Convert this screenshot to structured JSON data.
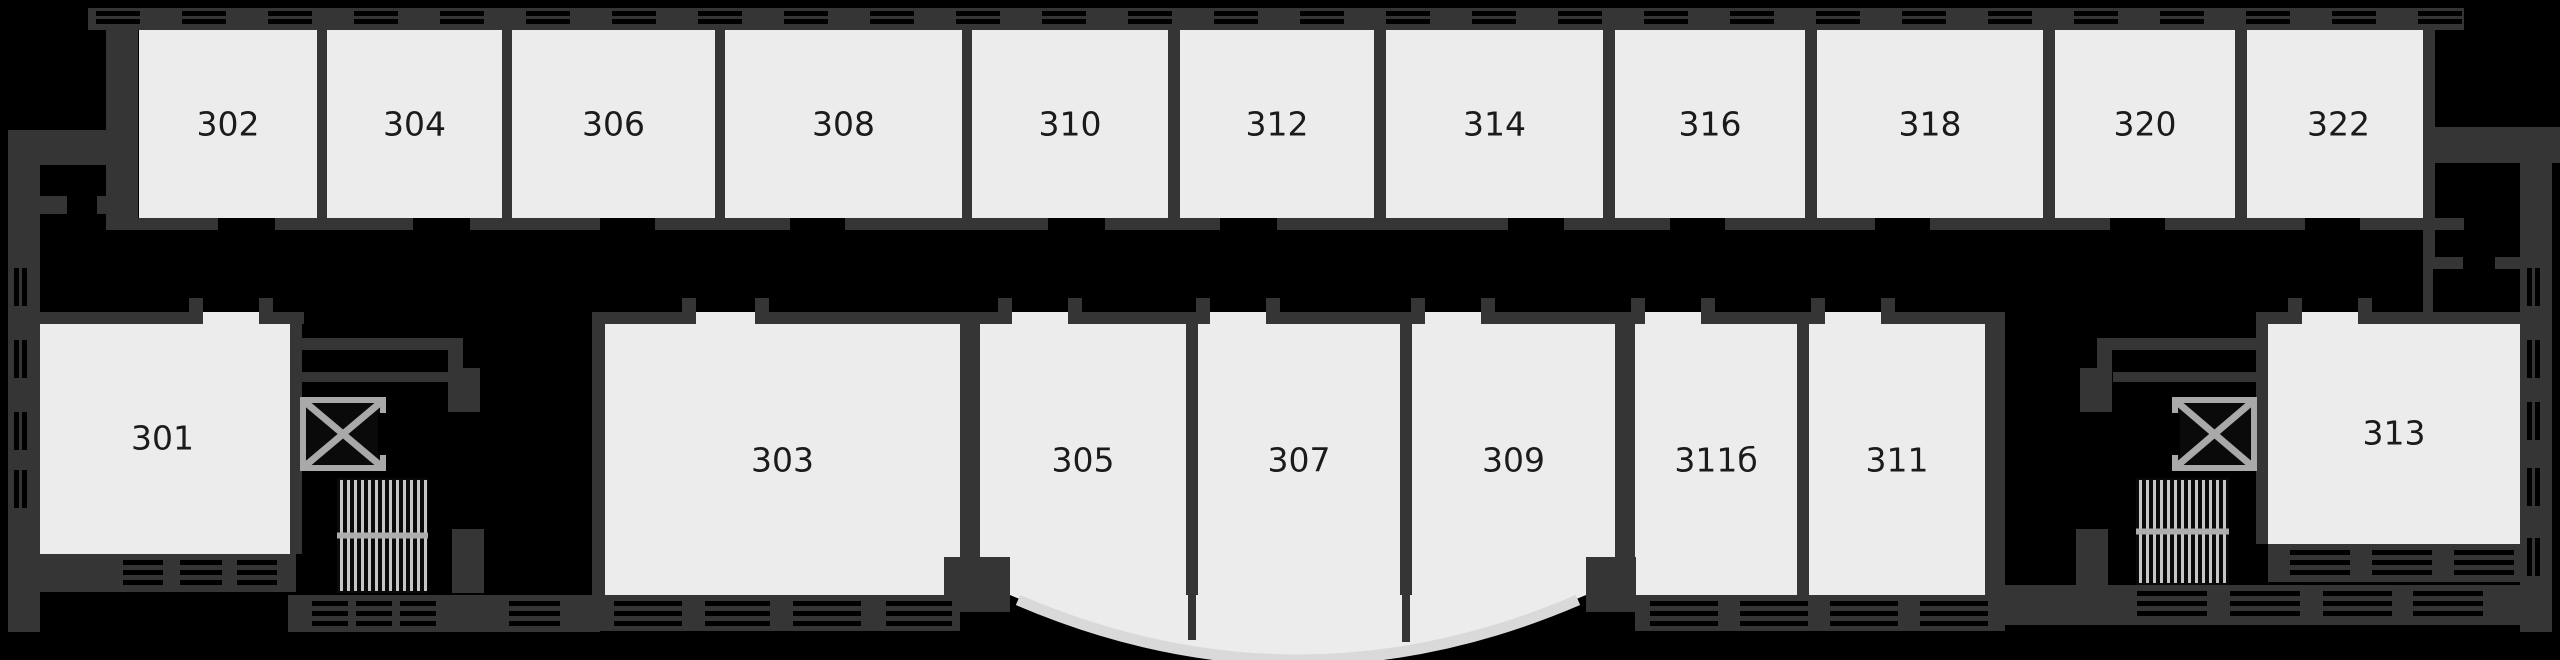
{
  "palette": {
    "background": "#000000",
    "wall": "#353535",
    "room_fill": "#ececec",
    "label_color": "#1b1b1b",
    "window_bar": "#000000",
    "fixture_gray": "#a9a9a9",
    "fixture_fill": "#0a0a0a",
    "stair_stripe": "#c6c6c6",
    "stair_rail": "#adadad",
    "bay_arc": "#d9d9d9"
  },
  "canvas": {
    "width": 2560,
    "height": 660
  },
  "diagram_data": {
    "type": "floor_plan",
    "top_row_rooms": [
      "302",
      "304",
      "306",
      "308",
      "310",
      "312",
      "314",
      "316",
      "318",
      "320",
      "322"
    ],
    "bottom_row_rooms": [
      "301",
      "303",
      "305",
      "307",
      "309",
      "311б",
      "311",
      "313"
    ],
    "fixtures": [
      "elevator-left",
      "stairs-left",
      "elevator-right",
      "stairs-right"
    ],
    "features": [
      "curved bay window under rooms 305-309",
      "window hatching along exterior walls",
      "central corridor between room rows"
    ]
  },
  "floorplan": {
    "rooms": {
      "top_row": {
        "y": 30,
        "h": 188,
        "label_cy": 124,
        "items": [
          {
            "label": "302",
            "x": 139,
            "w": 178,
            "door": [
              218,
              275
            ]
          },
          {
            "label": "304",
            "x": 327,
            "w": 175,
            "door": [
              413,
              470
            ]
          },
          {
            "label": "306",
            "x": 512,
            "w": 203,
            "door": [
              600,
              655
            ]
          },
          {
            "label": "308",
            "x": 725,
            "w": 237,
            "door": [
              790,
              845
            ]
          },
          {
            "label": "310",
            "x": 972,
            "w": 196,
            "door": [
              1048,
              1105
            ]
          },
          {
            "label": "312",
            "x": 1180,
            "w": 194,
            "door": [
              1220,
              1277
            ]
          },
          {
            "label": "314",
            "x": 1386,
            "w": 217,
            "door": [
              1508,
              1564
            ]
          },
          {
            "label": "316",
            "x": 1615,
            "w": 190,
            "door": [
              1670,
              1725
            ]
          },
          {
            "label": "318",
            "x": 1817,
            "w": 226,
            "door": [
              1875,
              1930
            ]
          },
          {
            "label": "320",
            "x": 2055,
            "w": 180,
            "door": [
              2110,
              2165
            ]
          },
          {
            "label": "322",
            "x": 2247,
            "w": 183,
            "door": [
              2305,
              2360
            ]
          }
        ]
      },
      "bottom_row": {
        "items": [
          {
            "label": "301",
            "x": 33,
            "y": 322,
            "w": 259,
            "h": 232,
            "door": [
              203,
              259
            ],
            "label_cy": 438
          },
          {
            "label": "303",
            "x": 605,
            "y": 324,
            "w": 355,
            "h": 271,
            "door": [
              696,
              755
            ],
            "label_cy": 460
          },
          {
            "label": "305",
            "x": 980,
            "y": 324,
            "w": 206,
            "h": 271,
            "door": [
              1012,
              1068
            ],
            "label_cy": 460
          },
          {
            "label": "307",
            "x": 1198,
            "y": 324,
            "w": 202,
            "h": 271,
            "door": [
              1210,
              1266
            ],
            "label_cy": 460
          },
          {
            "label": "309",
            "x": 1412,
            "y": 324,
            "w": 203,
            "h": 271,
            "door": [
              1425,
              1481
            ],
            "label_cy": 460
          },
          {
            "label": "311б",
            "x": 1635,
            "y": 324,
            "w": 162,
            "h": 271,
            "door": [
              1645,
              1701
            ],
            "label_cy": 460
          },
          {
            "label": "311",
            "x": 1809,
            "y": 324,
            "w": 176,
            "h": 271,
            "door": [
              1825,
              1881
            ],
            "label_cy": 460
          },
          {
            "label": "313",
            "x": 2268,
            "y": 322,
            "w": 252,
            "h": 222,
            "door": [
              2302,
              2358
            ],
            "label_cy": 433
          }
        ]
      }
    },
    "walls": [
      [
        88,
        8,
        2376,
        22,
        "top-window-band"
      ],
      [
        106,
        8,
        32,
        222,
        "left-end-wall"
      ],
      [
        8,
        130,
        130,
        35,
        "left-entry-band"
      ],
      [
        8,
        163,
        32,
        469,
        "left-exterior-wall"
      ],
      [
        32,
        196,
        35,
        18
      ],
      [
        97,
        196,
        33,
        18
      ],
      [
        2423,
        127,
        137,
        36,
        "right-entry-band"
      ],
      [
        2423,
        30,
        12,
        238,
        "right-end-wall"
      ],
      [
        2423,
        257,
        40,
        12
      ],
      [
        2495,
        257,
        32,
        12
      ],
      [
        2423,
        268,
        10,
        48
      ],
      [
        2520,
        163,
        32,
        469,
        "right-exterior-wall"
      ],
      [
        106,
        218,
        2358,
        12,
        "top-corridor-wall"
      ],
      [
        317,
        30,
        10,
        188
      ],
      [
        502,
        30,
        10,
        188
      ],
      [
        715,
        30,
        10,
        188
      ],
      [
        962,
        30,
        10,
        188
      ],
      [
        1168,
        30,
        12,
        188
      ],
      [
        1374,
        30,
        12,
        188
      ],
      [
        1603,
        30,
        12,
        188
      ],
      [
        1805,
        30,
        12,
        188
      ],
      [
        2043,
        30,
        12,
        188
      ],
      [
        2235,
        30,
        12,
        188
      ],
      [
        20,
        312,
        284,
        12
      ],
      [
        290,
        312,
        12,
        242
      ],
      [
        300,
        338,
        153,
        12
      ],
      [
        300,
        372,
        148,
        10
      ],
      [
        448,
        338,
        15,
        44
      ],
      [
        448,
        368,
        32,
        44
      ],
      [
        452,
        529,
        32,
        64
      ],
      [
        592,
        312,
        13,
        283
      ],
      [
        592,
        312,
        1413,
        12,
        "bottom-corridor-wall"
      ],
      [
        960,
        324,
        20,
        271
      ],
      [
        1186,
        324,
        12,
        271
      ],
      [
        1400,
        324,
        12,
        271
      ],
      [
        1615,
        324,
        20,
        271
      ],
      [
        1797,
        324,
        12,
        271
      ],
      [
        1985,
        324,
        20,
        271
      ],
      [
        1188,
        595,
        8,
        45
      ],
      [
        1402,
        595,
        8,
        47
      ],
      [
        944,
        557,
        66,
        55
      ],
      [
        1586,
        557,
        50,
        55
      ],
      [
        2256,
        312,
        264,
        12
      ],
      [
        2256,
        312,
        12,
        232
      ],
      [
        2108,
        338,
        153,
        12
      ],
      [
        2113,
        372,
        148,
        10
      ],
      [
        2097,
        338,
        15,
        44
      ],
      [
        2080,
        368,
        32,
        44
      ],
      [
        2076,
        529,
        32,
        64
      ],
      [
        33,
        554,
        263,
        38
      ],
      [
        598,
        595,
        362,
        36
      ],
      [
        1635,
        595,
        370,
        36
      ],
      [
        2268,
        544,
        252,
        38
      ],
      [
        288,
        595,
        312,
        37
      ],
      [
        2005,
        585,
        547,
        40
      ]
    ],
    "windows": {
      "top_band": {
        "start": 96,
        "period": 86,
        "glyph_w": 44,
        "count": 28,
        "bar_ys": [
          11,
          19
        ],
        "bar_h": 5
      },
      "h_strips": [
        {
          "groups": [
            [
              123,
              163
            ],
            [
              180,
              222
            ],
            [
              237,
              277
            ]
          ],
          "bar_ys": [
            560,
            570,
            580
          ],
          "bar_h": 5
        },
        {
          "groups": [
            [
              614,
              682
            ],
            [
              705,
              770
            ],
            [
              793,
              861
            ],
            [
              886,
              952
            ]
          ],
          "bar_ys": [
            601,
            611,
            621
          ],
          "bar_h": 5
        },
        {
          "groups": [
            [
              1650,
              1718
            ],
            [
              1740,
              1808
            ],
            [
              1830,
              1898
            ],
            [
              1920,
              1988
            ]
          ],
          "bar_ys": [
            601,
            611,
            621
          ],
          "bar_h": 5
        },
        {
          "groups": [
            [
              2290,
              2350
            ],
            [
              2372,
              2432
            ],
            [
              2454,
              2514
            ]
          ],
          "bar_ys": [
            550,
            560,
            570
          ],
          "bar_h": 5
        },
        {
          "groups": [
            [
              312,
              348
            ],
            [
              356,
              392
            ],
            [
              400,
              436
            ],
            [
              509,
              560
            ]
          ],
          "bar_ys": [
            601,
            611,
            621
          ],
          "bar_h": 5
        },
        {
          "groups": [
            [
              2137,
              2207
            ],
            [
              2230,
              2300
            ],
            [
              2323,
              2392
            ],
            [
              2413,
              2483
            ]
          ],
          "bar_ys": [
            591,
            601,
            611
          ],
          "bar_h": 5
        }
      ],
      "v_strips": [
        {
          "bar_xs": [
            14,
            22
          ],
          "bar_w": 5,
          "groups": [
            [
              268,
              306
            ],
            [
              340,
              378
            ],
            [
              412,
              450
            ],
            [
              470,
              508
            ]
          ]
        },
        {
          "bar_xs": [
            2527,
            2535
          ],
          "bar_w": 5,
          "groups": [
            [
              268,
              306
            ],
            [
              340,
              378
            ],
            [
              402,
              440
            ],
            [
              468,
              506
            ],
            [
              538,
              576
            ]
          ]
        }
      ]
    },
    "bay": {
      "fill_path": "M1010,595 Q1298,718 1586,595 Z",
      "arc_path": "M1018,600 Q1298,720 1578,600"
    },
    "fixtures": {
      "elevators": [
        {
          "x": 300,
          "y": 397,
          "w": 86,
          "h": 74,
          "door": "right"
        },
        {
          "x": 2172,
          "y": 397,
          "w": 85,
          "h": 74,
          "door": "left"
        }
      ],
      "stairs": [
        {
          "x": 337,
          "y": 478,
          "w": 91,
          "h": 115
        },
        {
          "x": 2136,
          "y": 478,
          "w": 93,
          "h": 107
        }
      ]
    }
  }
}
